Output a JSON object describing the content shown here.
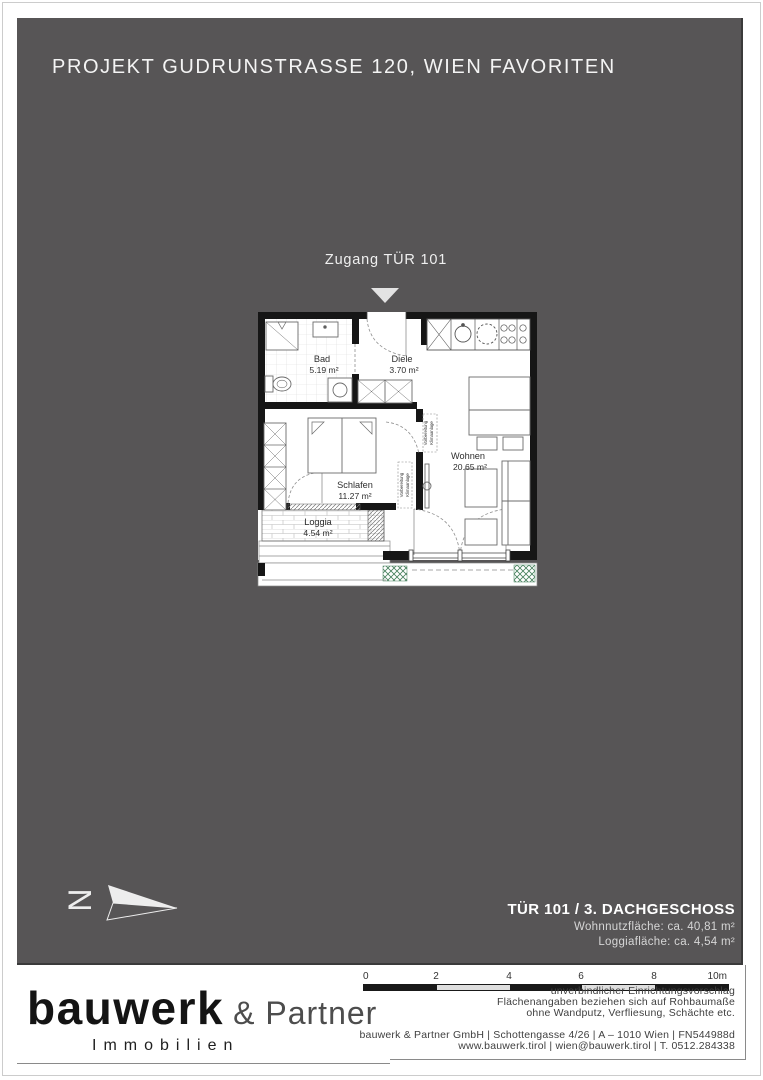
{
  "page": {
    "title": "PROJEKT GUDRUNSTRASSE 120, WIEN FAVORITEN"
  },
  "plan": {
    "entrance_label": "Zugang TÜR 101",
    "north_label": "N",
    "klima_line1": "Vorbereitung",
    "klima_line2": "Klimaanlage",
    "rooms": [
      {
        "name": "Bad",
        "area": "5.19 m²"
      },
      {
        "name": "Diele",
        "area": "3.70 m²"
      },
      {
        "name": "Schlafen",
        "area": "11.27 m²"
      },
      {
        "name": "Wohnen",
        "area": "20.65 m²"
      },
      {
        "name": "Loggia",
        "area": "4.54 m²"
      }
    ]
  },
  "info": {
    "title": "TÜR 101 / 3. DACHGESCHOSS",
    "line1": "Wohnnutzfläche: ca. 40,81 m²",
    "line2": "Loggiafläche: ca. 4,54 m²"
  },
  "footer": {
    "logo": {
      "name": "bauwerk",
      "suffix": "& Partner",
      "sub": "Immobilien"
    },
    "scale": {
      "labels": [
        "0",
        "2",
        "4",
        "6",
        "8",
        "10m"
      ]
    },
    "disclaimer": [
      "unverbindlicher Einrichtungsvorschlag",
      "Flächenangaben beziehen sich auf Rohbaumaße",
      "ohne Wandputz, Verfliesung, Schächte etc."
    ],
    "contact": [
      "bauwerk & Partner GmbH | Schottengasse 4/26 | A – 1010 Wien | FN544988d",
      "www.bauwerk.tirol | wien@bauwerk.tirol | T. 0512.284338"
    ]
  },
  "colors": {
    "panel": "#575556",
    "wall": "#161616",
    "planter_green": "#46805c"
  }
}
